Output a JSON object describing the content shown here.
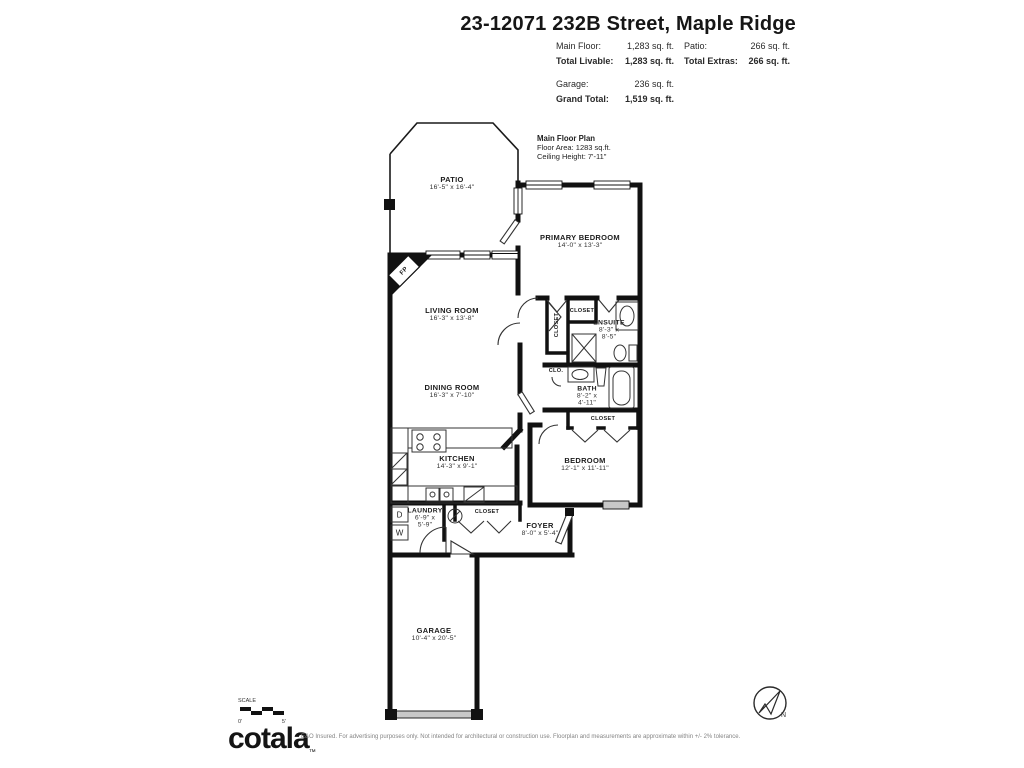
{
  "header": {
    "title": "23-12071 232B Street, Maple Ridge",
    "stats": {
      "left": [
        {
          "label": "Main Floor:",
          "value": "1,283 sq. ft."
        },
        {
          "label": "Total Livable:",
          "value": "1,283 sq. ft."
        },
        {
          "label": "Garage:",
          "value": "236 sq. ft."
        },
        {
          "label": "Grand Total:",
          "value": "1,519 sq. ft."
        }
      ],
      "right": [
        {
          "label": "Patio:",
          "value": "266 sq. ft."
        },
        {
          "label": "Total Extras:",
          "value": "266 sq. ft."
        }
      ]
    }
  },
  "plan": {
    "note": {
      "title": "Main Floor Plan",
      "area": "Floor Area: 1283 sq.ft.",
      "ceiling": "Ceiling Height: 7'-11\""
    },
    "rooms": {
      "patio": {
        "name": "PATIO",
        "dims": "16'-5\" x 16'-4\""
      },
      "primary_bedroom": {
        "name": "PRIMARY BEDROOM",
        "dims": "14'-0\" x 13'-3\""
      },
      "living_room": {
        "name": "LIVING ROOM",
        "dims": "16'-3\" x 13'-8\""
      },
      "dining_room": {
        "name": "DINING ROOM",
        "dims": "16'-3\" x 7'-10\""
      },
      "kitchen": {
        "name": "KITCHEN",
        "dims": "14'-3\" x 9'-1\""
      },
      "bedroom": {
        "name": "BEDROOM",
        "dims": "12'-1\" x 11'-11\""
      },
      "ensuite": {
        "name": "ENSUITE",
        "dims_l1": "8'-3\" x",
        "dims_l2": "8'-5\""
      },
      "bath": {
        "name": "BATH",
        "dims_l1": "8'-2\" x",
        "dims_l2": "4'-11\""
      },
      "laundry": {
        "name": "LAUNDRY",
        "dims_l1": "6'-9\" x",
        "dims_l2": "5'-9\""
      },
      "foyer": {
        "name": "FOYER",
        "dims": "8'-0\" x 5'-4\""
      },
      "garage": {
        "name": "GARAGE",
        "dims": "10'-4\" x 20'-5\""
      }
    },
    "markers": {
      "fireplace": "FP",
      "dryer": "D",
      "washer": "W",
      "closet": "CLOSET",
      "closet_small": "CLO.",
      "north": "N"
    }
  },
  "footer": {
    "scale": {
      "label": "SCALE",
      "start": "0'",
      "end": "5'"
    },
    "logo": "cotala",
    "logo_mark": "™",
    "disclaimer": "E&O Insured. For advertising purposes only. Not intended for architectural or construction use. Floorplan and measurements are approximate within +/- 2% tolerance."
  }
}
